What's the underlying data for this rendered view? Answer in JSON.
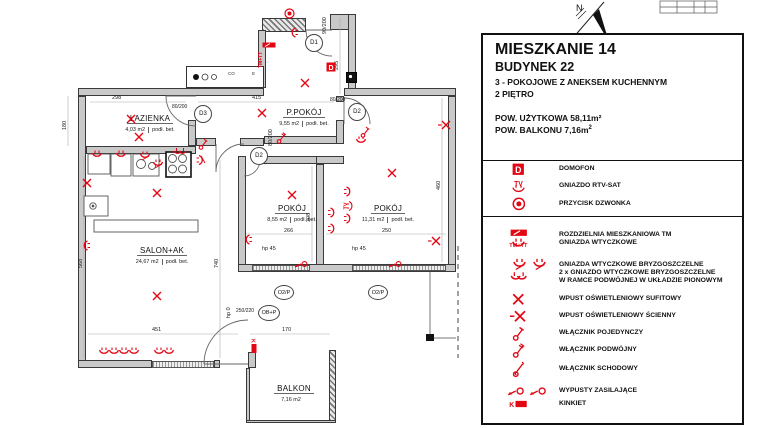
{
  "colors": {
    "accent_red": "#e30613",
    "wall_fill": "#c9c9c9"
  },
  "info_panel": {
    "title": "MIESZKANIE 14",
    "subtitle": "BUDYNEK 22",
    "type_line": "3 - POKOJOWE Z ANEKSEM KUCHENNYM",
    "floor_line": "2 PIĘTRO",
    "area_usable": "POW. UŻYTKOWA 58,11m²",
    "area_balcony": "POW. BALKONU 7,16m",
    "area_balcony_sup": "2",
    "legend": [
      {
        "icon": "domofon-icon",
        "label": "DOMOFON"
      },
      {
        "icon": "rtv-sat-socket-icon",
        "label": "GNIAZDO RTV-SAT"
      },
      {
        "icon": "doorbell-button-icon",
        "label": "PRZYCISK DZWONKA"
      },
      {
        "icon": "distribution-board-icon",
        "label": "ROZDZIELNIA MIESZKANIOWA TM",
        "icon_caption": "TM+TT"
      },
      {
        "icon": "socket-icon",
        "label": "GNIAZDA WTYCZKOWE"
      },
      {
        "icon": "splash-proof-socket-icon",
        "label": "GNIAZDA WTYCZKOWE BRYZGOSZCZELNE"
      },
      {
        "icon": "double-vertical-splash-socket-icon",
        "label": "2 x GNIAZDO WTYCZKOWE BRYZGOSZCZELNE",
        "label_line2": "W RAMCE PODWÓJNEJ W UKŁADZIE PIONOWYM"
      },
      {
        "icon": "ceiling-light-outlet-icon",
        "label": "WPUST OŚWIETLENIOWY SUFITOWY"
      },
      {
        "icon": "wall-light-outlet-icon",
        "label": "WPUST OŚWIETLENIOWY ŚCIENNY"
      },
      {
        "icon": "single-switch-icon",
        "label": "WŁĄCZNIK POJEDYNCZY"
      },
      {
        "icon": "double-switch-icon",
        "label": "WŁĄCZNIK PODWÓJNY"
      },
      {
        "icon": "stair-switch-icon",
        "label": "WŁĄCZNIK SCHODOWY"
      },
      {
        "icon": "power-outlet-icon",
        "label": "WYPUSTY ZASILAJĄCE"
      },
      {
        "icon": "wall-lamp-icon",
        "label": "KINKIET",
        "icon_caption": "K"
      }
    ]
  },
  "plan": {
    "rooms": [
      {
        "name": "ŁAZIENKA",
        "area": "4,03 m2",
        "floor": "podł. bet."
      },
      {
        "name": "P.POKÓJ",
        "area": "9,55 m2",
        "floor": "podł. bet."
      },
      {
        "name": "POKÓJ",
        "area": "8,55 m2",
        "floor": "podł. bet."
      },
      {
        "name": "POKÓJ",
        "area": "11,31 m2",
        "floor": "podł. bet."
      },
      {
        "name": "SALON+AK",
        "area": "24,67 m2",
        "floor": "podł. bet."
      },
      {
        "name": "BALKON",
        "area": "7,16 m2",
        "floor": ""
      }
    ],
    "doors": [
      {
        "id": "D1",
        "size": "90/200"
      },
      {
        "id": "D2",
        "size": "80/200"
      },
      {
        "id": "D2",
        "size": "80/200"
      },
      {
        "id": "D3",
        "size": "80/200"
      }
    ],
    "windows": [
      {
        "id": "O2/P"
      },
      {
        "id": "O2/P"
      },
      {
        "id": "OB+P",
        "size": "250/220"
      }
    ],
    "window_heights": [
      "hp 45",
      "hp 45",
      "hp 0"
    ],
    "dimensions": [
      "298",
      "415",
      "180",
      "295",
      "266",
      "250",
      "308",
      "460",
      "740",
      "568",
      "451",
      "170"
    ],
    "shaft_labels": [
      "CO",
      "E"
    ],
    "board_label": "TM+TT",
    "north_label": "N",
    "symbols": [
      {
        "t": "doorbell",
        "x": 284,
        "y": 8
      },
      {
        "t": "socket",
        "x": 288,
        "y": 28,
        "r": 90
      },
      {
        "t": "tm-board",
        "x": 262,
        "y": 42
      },
      {
        "t": "domofon",
        "x": 326,
        "y": 62
      },
      {
        "t": "ceiling-light",
        "x": 300,
        "y": 78
      },
      {
        "t": "ceiling-light",
        "x": 126,
        "y": 114
      },
      {
        "t": "ceiling-light",
        "x": 134,
        "y": 132
      },
      {
        "t": "switch-single",
        "x": 198,
        "y": 138
      },
      {
        "t": "ceiling-light",
        "x": 257,
        "y": 108
      },
      {
        "t": "switch-double",
        "x": 276,
        "y": 132
      },
      {
        "t": "switch-single",
        "x": 360,
        "y": 126
      },
      {
        "t": "socket",
        "x": 355,
        "y": 136
      },
      {
        "t": "socket",
        "x": 91,
        "y": 150
      },
      {
        "t": "socket",
        "x": 115,
        "y": 150
      },
      {
        "t": "socket-splash",
        "x": 139,
        "y": 150
      },
      {
        "t": "socket-splash",
        "x": 152,
        "y": 158
      },
      {
        "t": "socket-double",
        "x": 173,
        "y": 147
      },
      {
        "t": "socket-splash",
        "x": 194,
        "y": 154,
        "r": -90
      },
      {
        "t": "ceiling-light",
        "x": 82,
        "y": 178
      },
      {
        "t": "ceiling-light",
        "x": 152,
        "y": 188
      },
      {
        "t": "socket",
        "x": 80,
        "y": 241,
        "r": 90
      },
      {
        "t": "ceiling-light",
        "x": 152,
        "y": 291
      },
      {
        "t": "socket",
        "x": 98,
        "y": 347
      },
      {
        "t": "socket",
        "x": 108,
        "y": 347
      },
      {
        "t": "socket",
        "x": 118,
        "y": 347
      },
      {
        "t": "socket",
        "x": 128,
        "y": 347
      },
      {
        "t": "socket",
        "x": 153,
        "y": 347
      },
      {
        "t": "socket",
        "x": 163,
        "y": 347
      },
      {
        "t": "ceiling-light",
        "x": 287,
        "y": 190
      },
      {
        "t": "socket",
        "x": 242,
        "y": 235,
        "r": 90
      },
      {
        "t": "socket",
        "x": 326,
        "y": 208,
        "r": -90
      },
      {
        "t": "socket",
        "x": 326,
        "y": 224,
        "r": -90
      },
      {
        "t": "power-outlet",
        "x": 294,
        "y": 260
      },
      {
        "t": "ceiling-light",
        "x": 387,
        "y": 168
      },
      {
        "t": "socket",
        "x": 342,
        "y": 187,
        "r": -90
      },
      {
        "t": "rtv",
        "x": 342,
        "y": 200,
        "r": -90
      },
      {
        "t": "socket",
        "x": 342,
        "y": 214,
        "r": -90
      },
      {
        "t": "power-outlet",
        "x": 388,
        "y": 260
      },
      {
        "t": "wall-light",
        "x": 438,
        "y": 120
      },
      {
        "t": "wall-light",
        "x": 428,
        "y": 236
      },
      {
        "t": "kinkiet",
        "x": 246,
        "y": 342,
        "r": 90
      }
    ]
  }
}
